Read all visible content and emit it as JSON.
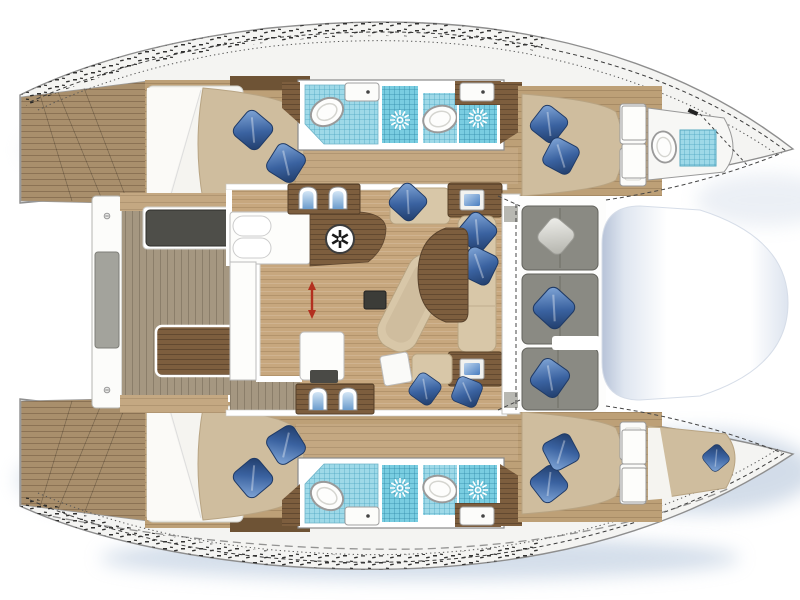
{
  "diagram": {
    "kind": "catamaran-yacht-floor-plan",
    "orientation": {
      "bow": "right",
      "stern": "left"
    },
    "hulls": [
      {
        "name": "port-hull-top",
        "areas": [
          {
            "name": "swim-platform",
            "finish": "teak"
          },
          {
            "name": "aft-double-cabin",
            "bed": "double",
            "pillows_blue": 2
          },
          {
            "name": "aft-bathroom",
            "fixtures": [
              "toilet",
              "sink",
              "shower-with-drain"
            ]
          },
          {
            "name": "mid-bathroom",
            "fixtures": [
              "toilet",
              "sink",
              "shower-with-drain"
            ]
          },
          {
            "name": "forward-double-cabin",
            "bed": "double",
            "pillows_blue": 2
          },
          {
            "name": "bow-head",
            "fixtures": [
              "toilet",
              "shower-pan"
            ]
          }
        ]
      },
      {
        "name": "starboard-hull-bottom",
        "areas": [
          {
            "name": "swim-platform",
            "finish": "teak"
          },
          {
            "name": "aft-double-cabin",
            "bed": "double",
            "pillows_blue": 2
          },
          {
            "name": "aft-bathroom",
            "fixtures": [
              "toilet",
              "sink",
              "shower-with-drain"
            ]
          },
          {
            "name": "mid-bathroom",
            "fixtures": [
              "toilet",
              "sink",
              "shower-with-drain"
            ]
          },
          {
            "name": "forward-double-cabin",
            "bed": "double",
            "pillows_blue": 2
          },
          {
            "name": "bow-berth",
            "pillows_blue": 1
          }
        ]
      }
    ],
    "bridgedeck": {
      "aft_cockpit": {
        "items": [
          "aft-beam-bench-with-pad",
          "charcoal-bench",
          "white-seat-modules",
          "cockpit-table",
          "gray-seat-with-blue-pillow",
          "teak-sole"
        ]
      },
      "saloon": {
        "galley": [
          "white-counter",
          "twin-round-fixtures",
          "wood-counter-with-fridge",
          "island-unit-with-dark-sink",
          "sliding-door-red-arrow"
        ],
        "companionways": 2,
        "lounge": [
          "chaise-longue",
          "coffee-table"
        ],
        "dinette": {
          "benches": "U-shaped",
          "table": "wood",
          "pillows_blue": 5,
          "corner-consoles-with-screens": 2
        }
      },
      "forward_cockpit": {
        "bench_sections": 3,
        "pillows": [
          "white",
          "blue",
          "blue"
        ]
      },
      "trampoline": {
        "shape": "rounded",
        "color": "white"
      }
    },
    "icons": [
      "pillow-icon",
      "toilet-icon",
      "sink-icon",
      "shower-drain-sun-icon",
      "fridge-snowflake-icon",
      "companionway-steps-icon",
      "instrument-screen-icon",
      "sliding-door-arrow-icon",
      "screw-icon",
      "cleat-icon",
      "lifeline-dashes"
    ]
  },
  "palette": {
    "hull_white": "#f4f4f2",
    "hull_stroke": "#8e8e8e",
    "teak": "#a98f6c",
    "teak_gray": "#a59781",
    "floor_wood": "#c7a77e",
    "hull_floor": "#bda077",
    "counter_wood": "#7d5e3e",
    "wall_wood": "#6e5335",
    "bed_beige": "#cfbd9e",
    "bed_white": "#f5f4f0",
    "cushion_beige": "#d8c7a8",
    "cushion_gray": "#8a8a83",
    "charcoal": "#4e4e49",
    "pad_gray": "#a3a39c",
    "bath_tile": "#9ed9e8",
    "shower_tile": "#79cde1",
    "fixture_white": "#fbfbfa",
    "pillow_blue": "#3a62a0",
    "pillow_white": "#d9d9d4",
    "accent_red": "#b3301f",
    "screen_blue": "#5b8fd6",
    "shadow_blue": "#a9bdd6",
    "tramp_edge": "#b7c3d8"
  }
}
